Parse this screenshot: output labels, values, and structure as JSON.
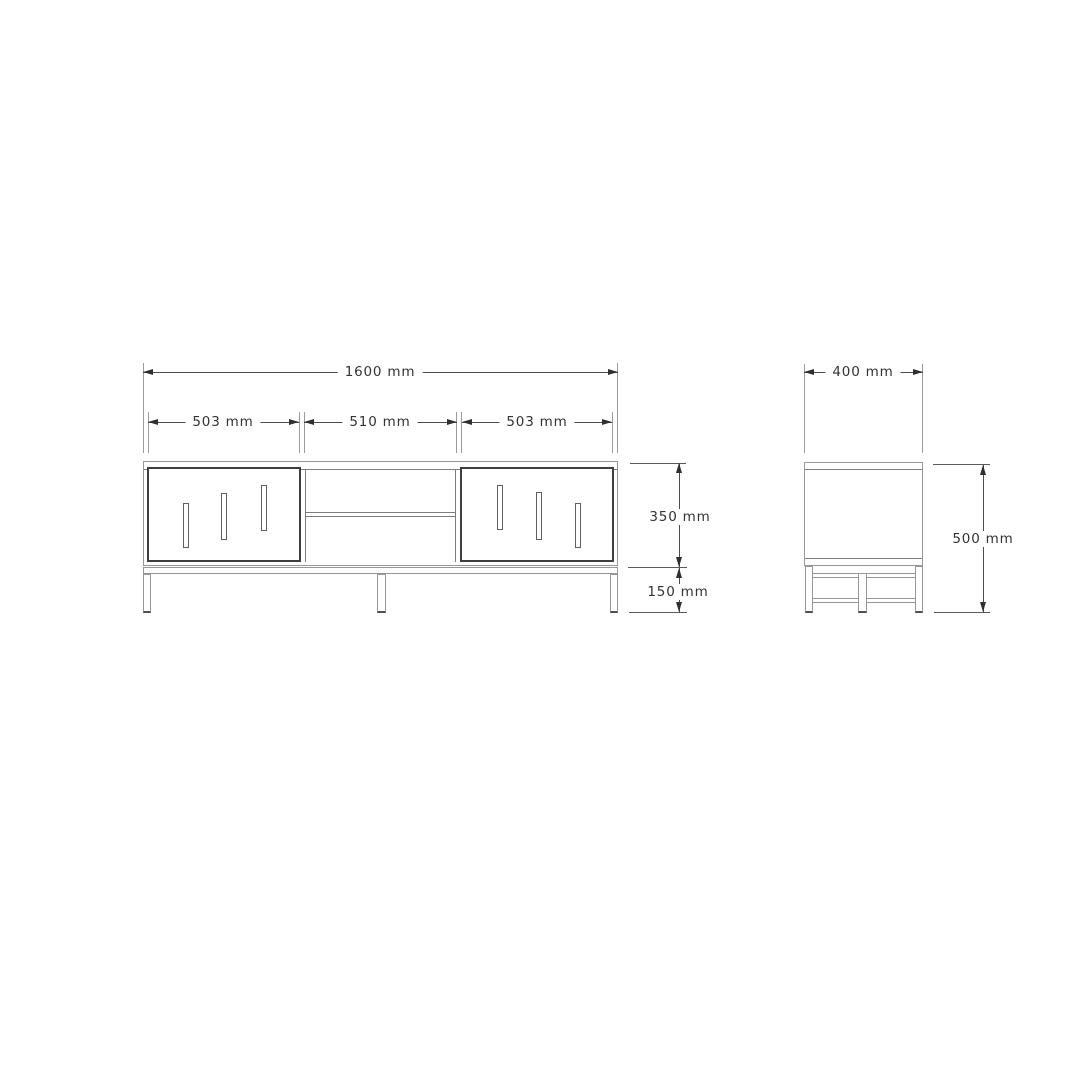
{
  "document": {
    "type": "technical-drawing",
    "subject": "TV stand dimension diagram (front and side orthographic views)",
    "background": "#ffffff"
  },
  "colors": {
    "outline_light": "#979797",
    "outline_dark": "#3f3f3f",
    "dimension_line": "#4c4c4c",
    "arrow": "#2f2f2f",
    "text": "#333333"
  },
  "front_view": {
    "name": "front view",
    "dim_total_width": "1600 mm",
    "dim_left_section": "503 mm",
    "dim_center_section": "510 mm",
    "dim_right_section": "503 mm",
    "dim_body_height": "350 mm",
    "dim_base_height": "150 mm",
    "features": {
      "left_door_slots": 3,
      "right_door_slots": 3,
      "center_shelf": 1,
      "legs": 3
    }
  },
  "side_view": {
    "name": "side view",
    "dim_depth": "400 mm",
    "dim_total_height": "500 mm",
    "features": {
      "legs": 2,
      "stretcher_rails": 2,
      "middle_post": 1
    }
  }
}
